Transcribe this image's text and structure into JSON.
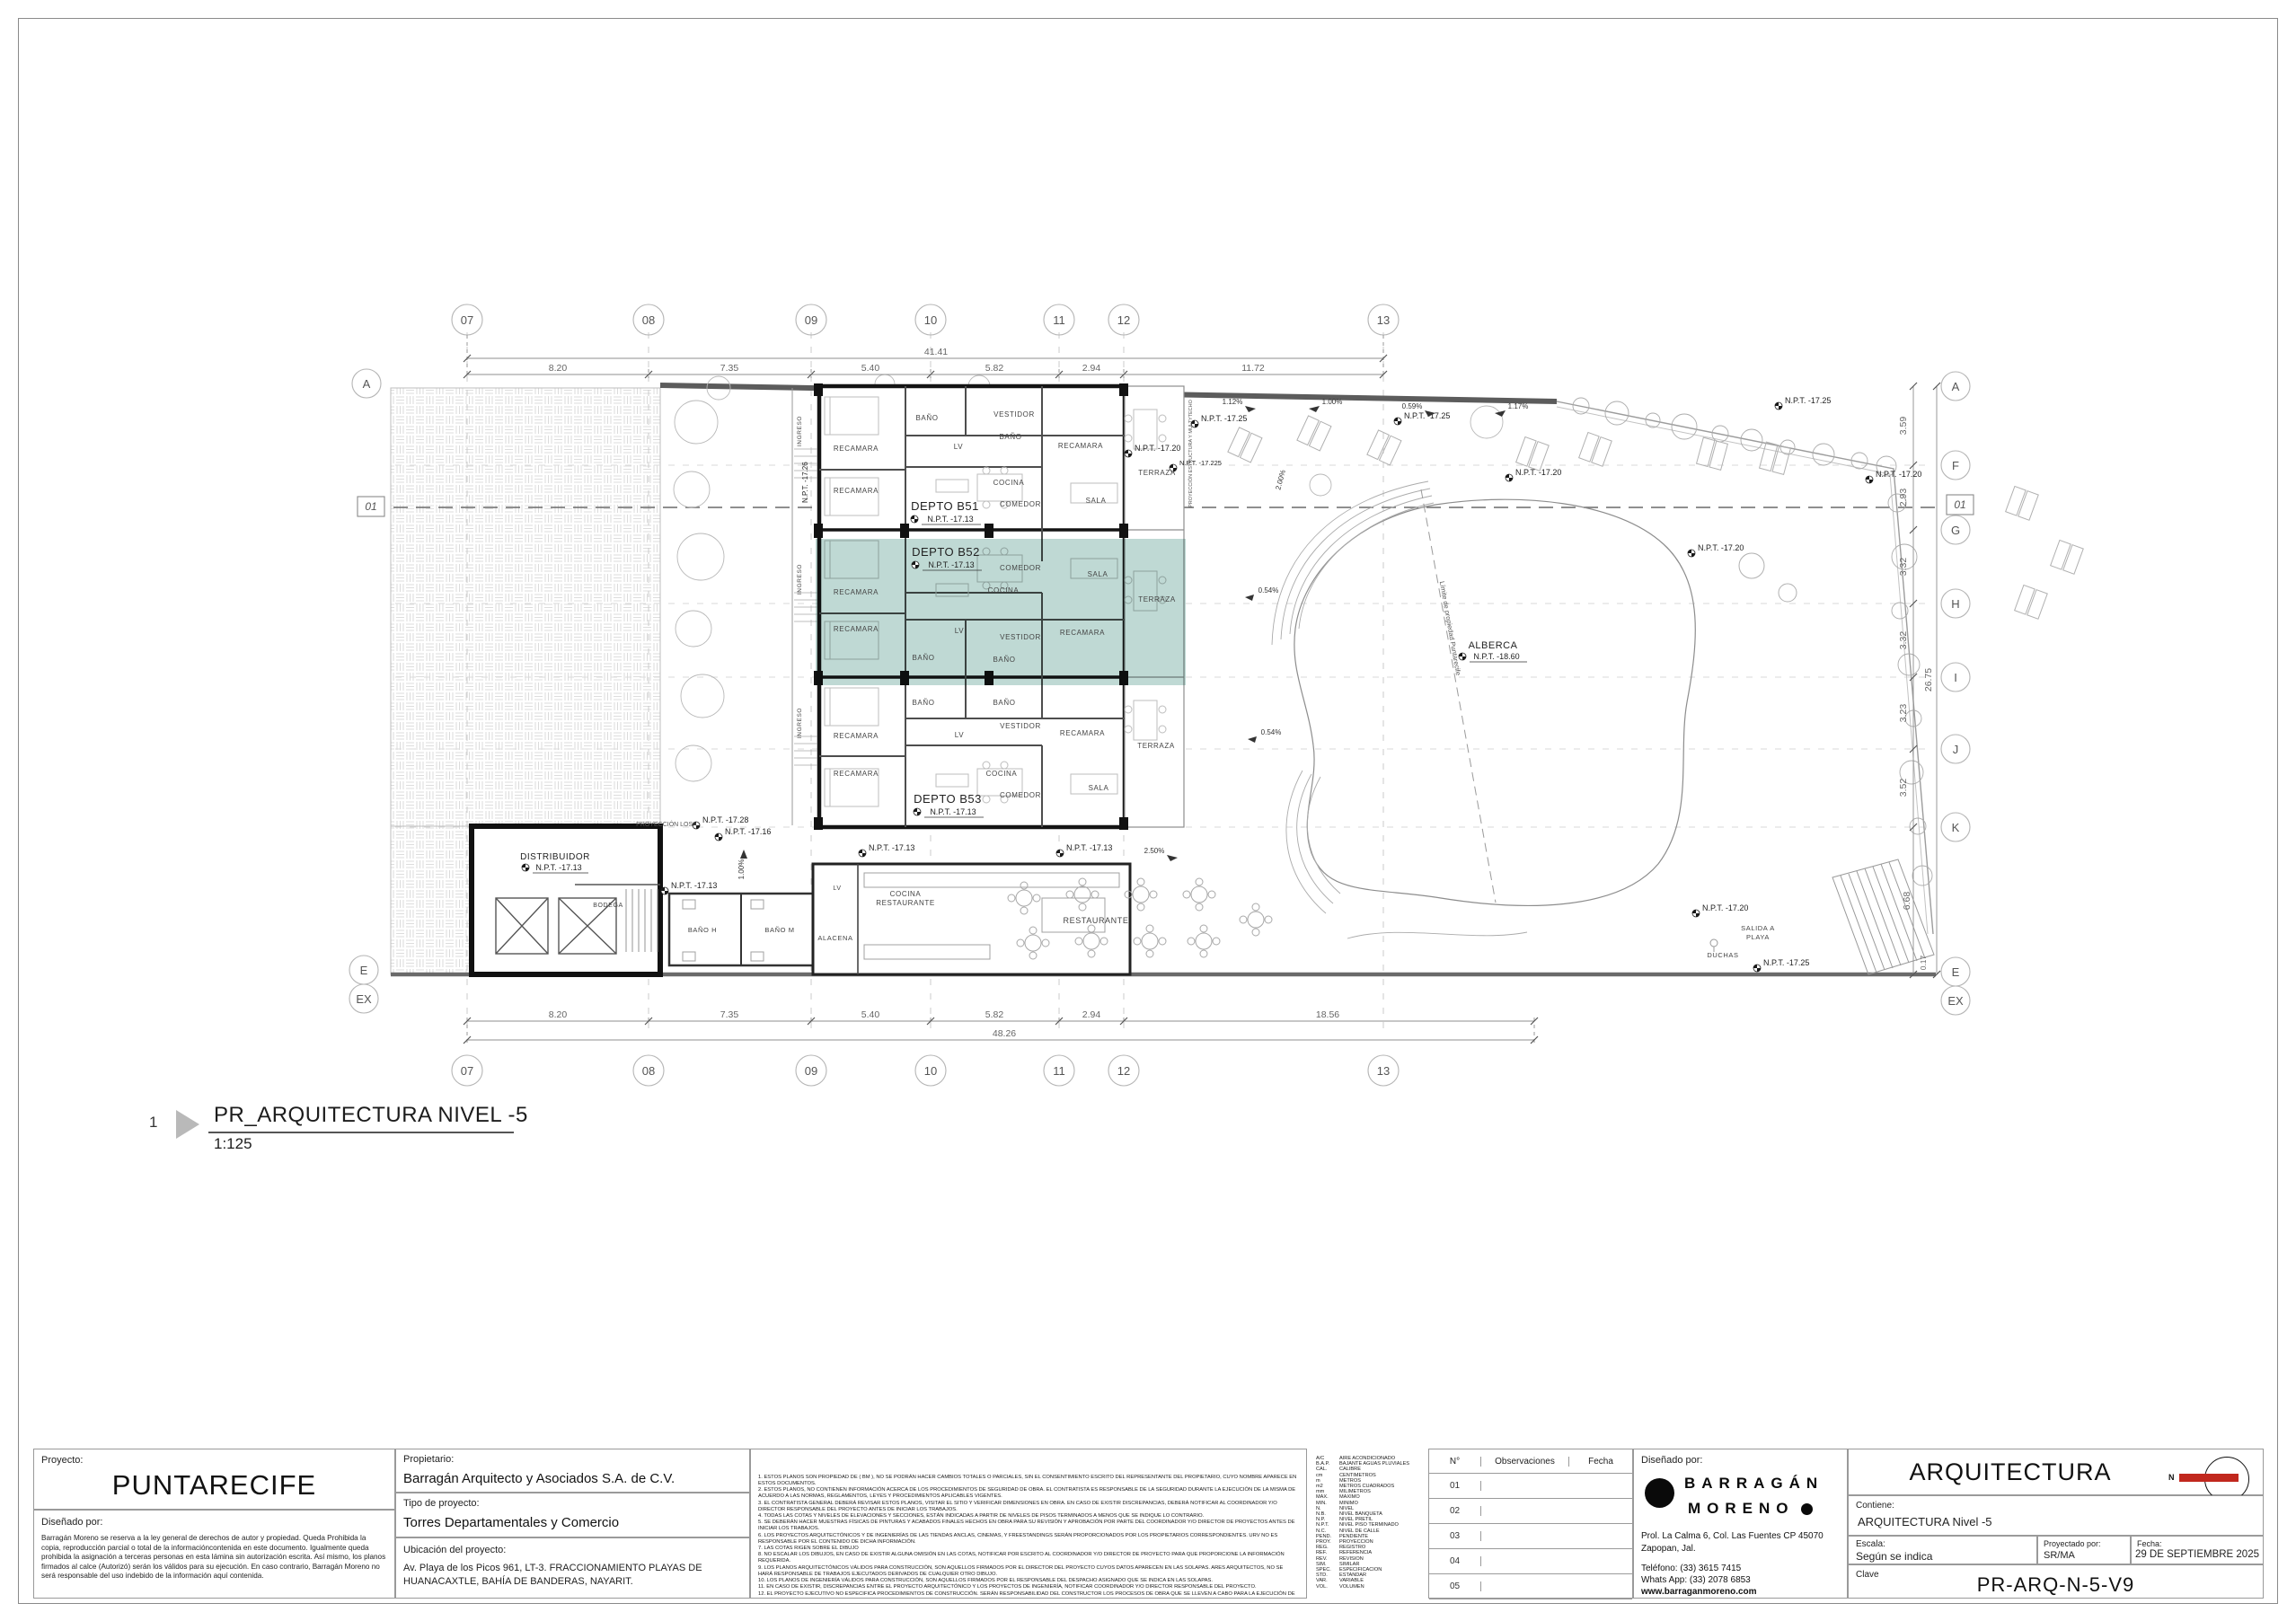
{
  "view_title": {
    "number": "1",
    "title": "PR_ARQUITECTURA NIVEL -5",
    "scale": "1:125"
  },
  "colors": {
    "highlight": "#7FB3A9",
    "north": "#C1281E",
    "wall": "#141414"
  },
  "plan": {
    "grid_columns": [
      "07",
      "08",
      "09",
      "10",
      "11",
      "12",
      "13"
    ],
    "grid_rows": [
      "A",
      "F",
      "G",
      "H",
      "I",
      "J",
      "K",
      "E",
      "EX"
    ],
    "section_marker": "01",
    "dims": {
      "top_segments": [
        "8.20",
        "7.35",
        "5.40",
        "5.82",
        "2.94",
        "11.72"
      ],
      "top_total": "41.41",
      "bottom_segments": [
        "8.20",
        "7.35",
        "5.40",
        "5.82",
        "2.94",
        "18.56"
      ],
      "bottom_total": "48.26",
      "right_segments": [
        "3.59",
        "2.93",
        "3.32",
        "3.32",
        "3.23",
        "3.52",
        "6.68",
        "0.17"
      ],
      "right_total": "26.75"
    },
    "units": {
      "b51": {
        "name": "DEPTO B51",
        "level": "N.P.T. -17.13"
      },
      "b52": {
        "name": "DEPTO B52",
        "level": "N.P.T. -17.13"
      },
      "b53": {
        "name": "DEPTO B53",
        "level": "N.P.T. -17.13"
      },
      "alberca": {
        "name": "ALBERCA",
        "level": "N.P.T. -18.60"
      },
      "distribuidor": {
        "name": "DISTRIBUIDOR",
        "level": "N.P.T. -17.13"
      }
    },
    "rooms": {
      "recamara": "RECAMARA",
      "bano": "BAÑO",
      "bano_h": "BAÑO H",
      "bano_m": "BAÑO M",
      "vestidor": "VESTIDOR",
      "lv": "LV",
      "cocina": "COCINA",
      "comedor": "COMEDOR",
      "sala": "SALA",
      "terraza": "TERRAZA",
      "ingreso": "INGRESO",
      "bodega": "BODEGA",
      "alacena": "ALACENA",
      "restaurante": "RESTAURANTE",
      "salida1": "SALIDA A",
      "salida2": "PLAYA",
      "duchas": "DUCHAS"
    },
    "levels": {
      "n1713": "N.P.T. -17.13",
      "n1716": "N.P.T. -17.16",
      "n1720": "N.P.T. -17.20",
      "n17225": "N.P.T. -17.225",
      "n1725": "N.P.T. -17.25",
      "n1726": "N.P.T. -17.26",
      "n1728": "N.P.T. -17.28",
      "n1860": "N.P.T. -18.60"
    },
    "slopes": {
      "s054": "0.54%",
      "s059": "0.59%",
      "s100": "1.00%",
      "s112": "1.12%",
      "s117": "1.17%",
      "s200": "2.00%",
      "s250": "2.50%"
    },
    "annotations": {
      "proyeccion_losa": "PROYECCIÓN LOSA",
      "proyeccion_estructura": "PROYECCIÓN ESTRUCTURA Y MULTYTECHO",
      "limite_propiedad": "Límite de propiedad Puntarecife"
    }
  },
  "titleblock": {
    "proyecto_label": "Proyecto:",
    "proyecto": "PUNTARECIFE",
    "disenado_label": "Diseñado por:",
    "legal": "Barragán Moreno se reserva a la ley general de derechos de autor y propiedad. Queda Prohibida la copia, reproducción parcial o total de la informacióncontenida en este documento. Igualmente queda prohibida la asignación a terceras personas en esta lámina sin autorización escrita. Así mismo, los planos firmados al calce (Autorizó) serán los válidos para su ejecución. En caso contrario, Barragán Moreno no será responsable del uso indebido de la información aquí contenida.",
    "propietario_label": "Propietario:",
    "propietario": "Barragán Arquitecto y Asociados S.A. de C.V.",
    "tipo_label": "Tipo de proyecto:",
    "tipo": "Torres Departamentales y Comercio",
    "ubicacion_label": "Ubicación del proyecto:",
    "ubicacion": "Av. Playa de los Picos 961, LT-3. FRACCIONAMIENTO PLAYAS DE HUANACAXTLE, BAHÍA DE BANDERAS, NAYARIT.",
    "notes": [
      "1. ESTOS PLANOS SON PROPIEDAD DE ( BM ), NO SE PODRÁN HACER CAMBIOS TOTALES O PARCIALES, SIN EL CONSENTIMIENTO ESCRITO DEL REPRESENTANTE DEL PROPIETARIO, CUYO NOMBRE APARECE EN ESTOS DOCUMENTOS.",
      "2. ESTOS PLANOS, NO CONTIENEN INFORMACIÓN ACERCA DE LOS PROCEDIMIENTOS DE SEGURIDAD DE OBRA. EL CONTRATISTA ES RESPONSABLE DE LA SEGURIDAD DURANTE LA EJECUCIÓN DE LA MISMA DE ACUERDO A LAS NORMAS, REGLAMENTOS, LEYES Y PROCEDIMIENTOS APLICABLES VIGENTES.",
      "3. EL CONTRATISTA GENERAL DEBERÁ REVISAR ESTOS PLANOS, VISITAR EL SITIO Y VERIFICAR DIMENSIONES EN OBRA. EN CASO DE EXISTIR DISCREPANCIAS, DEBERÁ NOTIFICAR AL COORDINADOR Y/O DIRECTOR RESPONSABLE DEL PROYECTO ANTES DE INICIAR LOS TRABAJOS.",
      "4. TODAS LAS COTAS Y NIVELES DE ELEVACIONES Y SECCIONES, ESTÁN INDICADAS A PARTIR DE NIVELES DE PISOS TERMINADOS A MENOS QUE SE INDIQUE LO CONTRARIO.",
      "5. SE DEBERÁN HACER MUESTRAS FÍSICAS DE PINTURAS Y ACABADOS FINALES HECHOS EN OBRA PARA SU REVISIÓN Y APROBACIÓN POR PARTE DEL COORDINADOR Y/O DIRECTOR DE PROYECTOS ANTES DE INICIAR LOS TRABAJOS.",
      "6. LOS PROYECTOS ARQUITECTÓNICOS Y DE INGENIERÍAS DE LAS TIENDAS ANCLAS, CINEMAS, Y FREESTANDINGS SERÁN PROPORCIONADOS POR LOS PROPIETARIOS CORRESPONDIENTES. URV NO ES RESPONSABLE POR EL CONTENIDO DE DICHA INFORMACIÓN.",
      "7. LAS COTAS RIGEN SOBRE EL DIBUJO",
      "8. NO ESCALAR LOS DIBUJOS, EN CASO DE EXISTIR ALGUNA OMISIÓN EN LAS COTAS, NOTIFICAR POR ESCRITO AL COORDINADOR Y/O DIRECTOR DE PROYECTO PARA QUE PROPORCIONE LA INFORMACIÓN REQUERIDA.",
      "9. LOS PLANOS ARQUITECTÓNICOS VÁLIDOS PARA CONSTRUCCIÓN, SON AQUELLOS FIRMADOS POR EL DIRECTOR DEL PROYECTO CUYOS DATOS APARECEN EN LAS SOLAPAS. ARES ARQUITECTOS, NO SE HARÁ RESPONSABLE DE TRABAJOS EJECUTADOS DERIVADOS DE CUALQUIER OTRO DIBUJO.",
      "10. LOS PLANOS DE INGENIERÍA VÁLIDOS PARA CONSTRUCCIÓN, SON AQUELLOS FIRMADOS POR EL RESPONSABLE DEL DESPACHO ASIGNADO QUE SE INDICA EN LAS SOLAPAS.",
      "11. EN CASO DE EXISTIR, DISCREPANCIAS ENTRE EL PROYECTO ARQUITECTÓNICO Y LOS PROYECTOS DE INGENIERÍA, NOTIFICAR COORDINADOR Y/O DIRECTOR RESPONSABLE DEL PROYECTO.",
      "12. EL PROYECTO EJECUTIVO NO ESPECIFICA PROCEDIMIENTOS DE CONSTRUCCIÓN. SERÁN RESPONSABILIDAD DEL CONSTRUCTOR LOS PROCESOS DE OBRA QUE SE LLEVEN A CABO PARA LA EJECUCIÓN DE LOS TRABAJOS.",
      "13. EL DIBUJO DE ELEMENTOS ESTRUCTURALES ES SÓLO REPRESENTATIVO Y DEBERÁ REFERIRSE A LOS PLANOS ESTRUCTURALES.",
      "14. LAS COTAS Y NIVELES EN METROS.",
      "15. PARA LA ADAPTACIÓN DE LOCALES Y SUBANCLAS, REVISAR EL MANUAL DE ADAPTACIONES CORRESPONDIENTE."
    ],
    "abbreviations": [
      {
        "abbr": "A/C",
        "full": "AIRE ACONDICIONADO"
      },
      {
        "abbr": "B.A.P.",
        "full": "BAJANTE AGUAS PLUVIALES"
      },
      {
        "abbr": "CAL.",
        "full": "CALIBRE"
      },
      {
        "abbr": "cm",
        "full": "CENTIMETROS"
      },
      {
        "abbr": "m",
        "full": "METROS"
      },
      {
        "abbr": "m2",
        "full": "METROS CUADRADOS"
      },
      {
        "abbr": "mm",
        "full": "MILIMETROS"
      },
      {
        "abbr": "MAX.",
        "full": "MAXIMO"
      },
      {
        "abbr": "MIN.",
        "full": "MINIMO"
      },
      {
        "abbr": "N.",
        "full": "NIVEL"
      },
      {
        "abbr": "N.B.",
        "full": "NIVEL BANQUETA"
      },
      {
        "abbr": "N.P.",
        "full": "NIVEL PRETIL"
      },
      {
        "abbr": "N.P.T.",
        "full": "NIVEL PISO TERMINADO"
      },
      {
        "abbr": "N.C.",
        "full": "NIVEL DE CALLE"
      },
      {
        "abbr": "PEND.",
        "full": "PENDIENTE"
      },
      {
        "abbr": "PROY.",
        "full": "PROYECCION"
      },
      {
        "abbr": "REG.",
        "full": "REGISTRO"
      },
      {
        "abbr": "REF.",
        "full": "REFERENCIA"
      },
      {
        "abbr": "REV.",
        "full": "REVISION"
      },
      {
        "abbr": "SIM.",
        "full": "SIMILAR"
      },
      {
        "abbr": "SPEC.",
        "full": "ESPECIFICACION"
      },
      {
        "abbr": "STD.",
        "full": "ESTANDAR"
      },
      {
        "abbr": "VAR.",
        "full": "VARIABLE"
      },
      {
        "abbr": "VOL.",
        "full": "VOLUMEN"
      }
    ],
    "revision_table": {
      "col_num": "N°",
      "col_obs": "Observaciones",
      "col_fecha": "Fecha",
      "rows": [
        "01",
        "02",
        "03",
        "04",
        "05"
      ]
    },
    "designer": {
      "label": "Diseñado por:",
      "line1": "BARRAGÁN",
      "line2": "MORENO",
      "address1": "Prol. La Calma 6, Col. Las Fuentes CP 45070",
      "address2": "Zapopan, Jal.",
      "phone": "Teléfono: (33) 3615 7415",
      "whatsapp": "Whats App: (33) 2078 6853",
      "web": "www.barraganmoreno.com"
    },
    "sheet": {
      "discipline": "ARQUITECTURA",
      "north_letter": "N",
      "contiene_label": "Contiene:",
      "contiene": "ARQUITECTURA Nivel -5",
      "escala_label": "Escala:",
      "escala": "Según se indica",
      "proyectado_label": "Proyectado por:",
      "proyectado": "SR/MA",
      "fecha_label": "Fecha:",
      "fecha": "29 DE SEPTIEMBRE 2025",
      "clave_label": "Clave",
      "clave": "PR-ARQ-N-5-V9"
    }
  }
}
